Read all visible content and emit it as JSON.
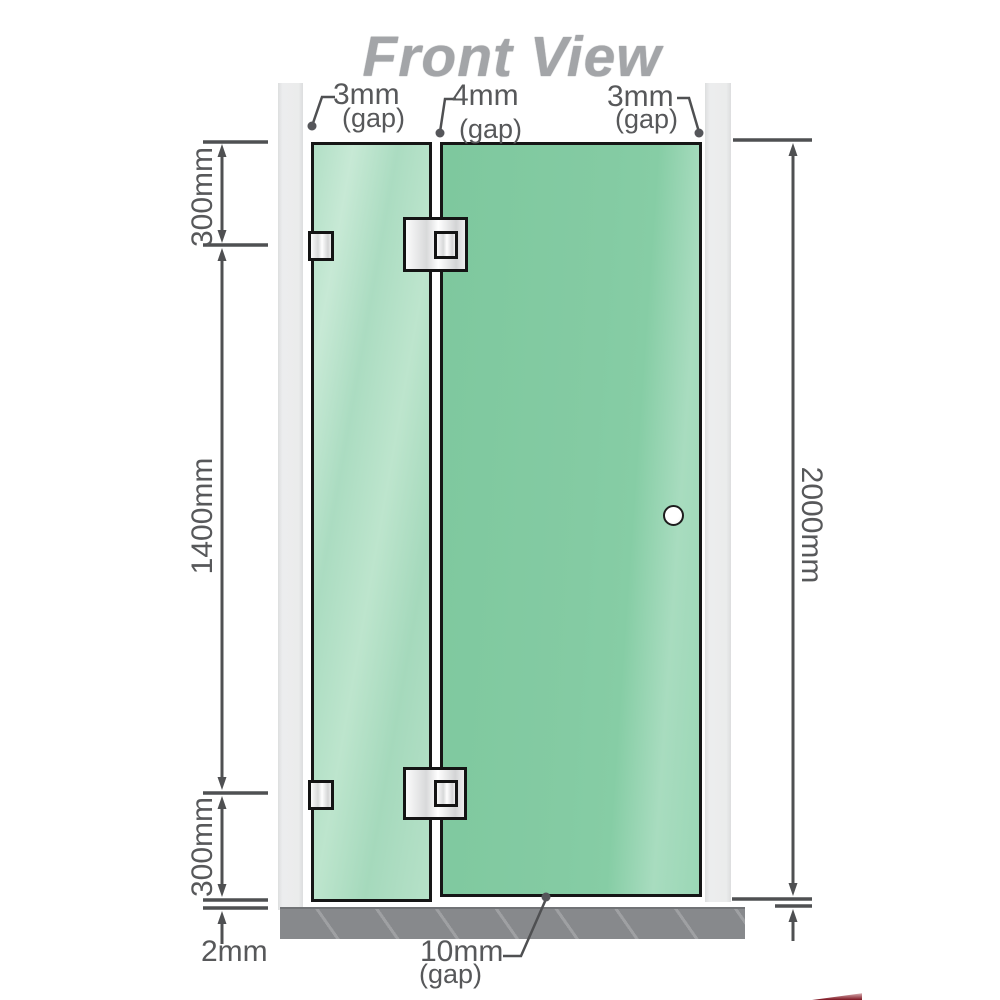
{
  "title": "Front View",
  "labels": {
    "gap_top_left": {
      "value": "3mm",
      "suffix": "(gap)"
    },
    "gap_top_mid": {
      "value": "4mm",
      "suffix": "(gap)"
    },
    "gap_top_right": {
      "value": "3mm",
      "suffix": "(gap)"
    },
    "dim_left_top": "300mm",
    "dim_left_mid": "1400mm",
    "dim_left_bottom": "300mm",
    "dim_right": "2000mm",
    "dim_floor_gap": "2mm",
    "gap_bottom": {
      "value": "10mm",
      "suffix": "(gap)"
    }
  },
  "colors": {
    "glass_fixed_panel": "#aedec3",
    "glass_door_panel": "#84cba4",
    "wall_channel": "#e9eaea",
    "floor": "#87898c",
    "dimension_line": "#4f5052",
    "annotation_text": "#57585a",
    "title_text": "#a3a5a8",
    "hinge_metal": "#e8e8e8"
  }
}
